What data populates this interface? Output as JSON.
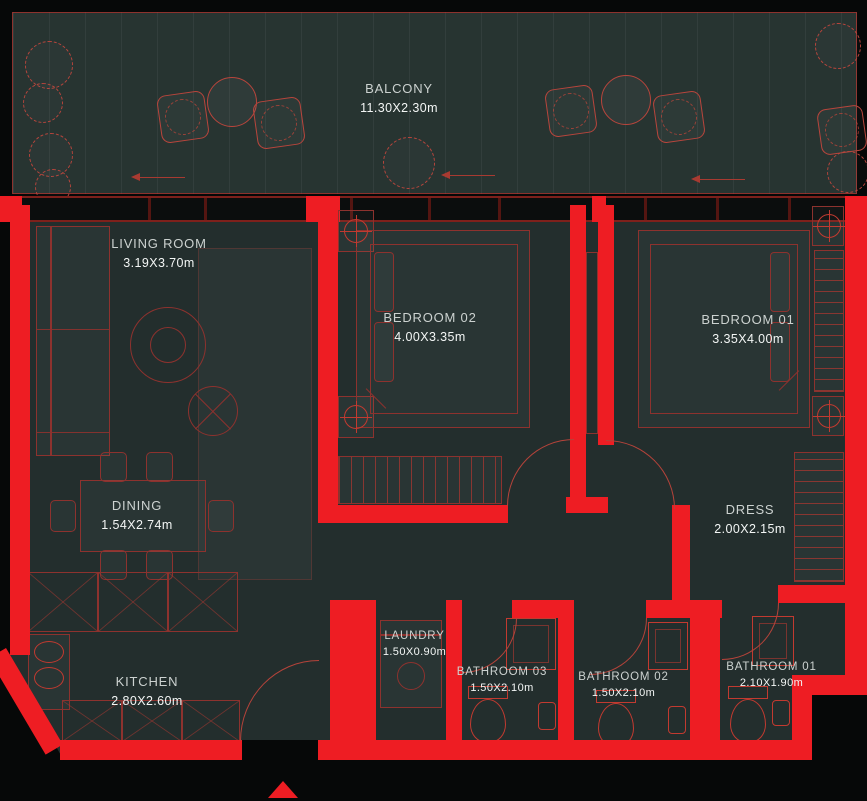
{
  "colors": {
    "bg": "#060808",
    "floor": "#232e2d",
    "balcony": "#273431",
    "wall": "#ee1d23",
    "outline": "#8d322e",
    "fixture": "#c23a30",
    "label": "#ccd2d0",
    "dims": "#f3f6f5"
  },
  "rooms": {
    "balcony": {
      "name": "BALCONY",
      "dims": "11.30X2.30m"
    },
    "living": {
      "name": "LIVING ROOM",
      "dims": "3.19X3.70m"
    },
    "bedroom2": {
      "name": "BEDROOM 02",
      "dims": "4.00X3.35m"
    },
    "bedroom1": {
      "name": "BEDROOM 01",
      "dims": "3.35X4.00m"
    },
    "dining": {
      "name": "DINING",
      "dims": "1.54X2.74m"
    },
    "dress": {
      "name": "DRESS",
      "dims": "2.00X2.15m"
    },
    "kitchen": {
      "name": "KITCHEN",
      "dims": "2.80X2.60m"
    },
    "laundry": {
      "name": "LAUNDRY",
      "dims": "1.50X0.90m"
    },
    "bath3": {
      "name": "BATHROOM 03",
      "dims": "1.50X2.10m"
    },
    "bath2": {
      "name": "BATHROOM 02",
      "dims": "1.50X2.10m"
    },
    "bath1": {
      "name": "BATHROOM 01",
      "dims": "2.10X1.90m"
    }
  }
}
